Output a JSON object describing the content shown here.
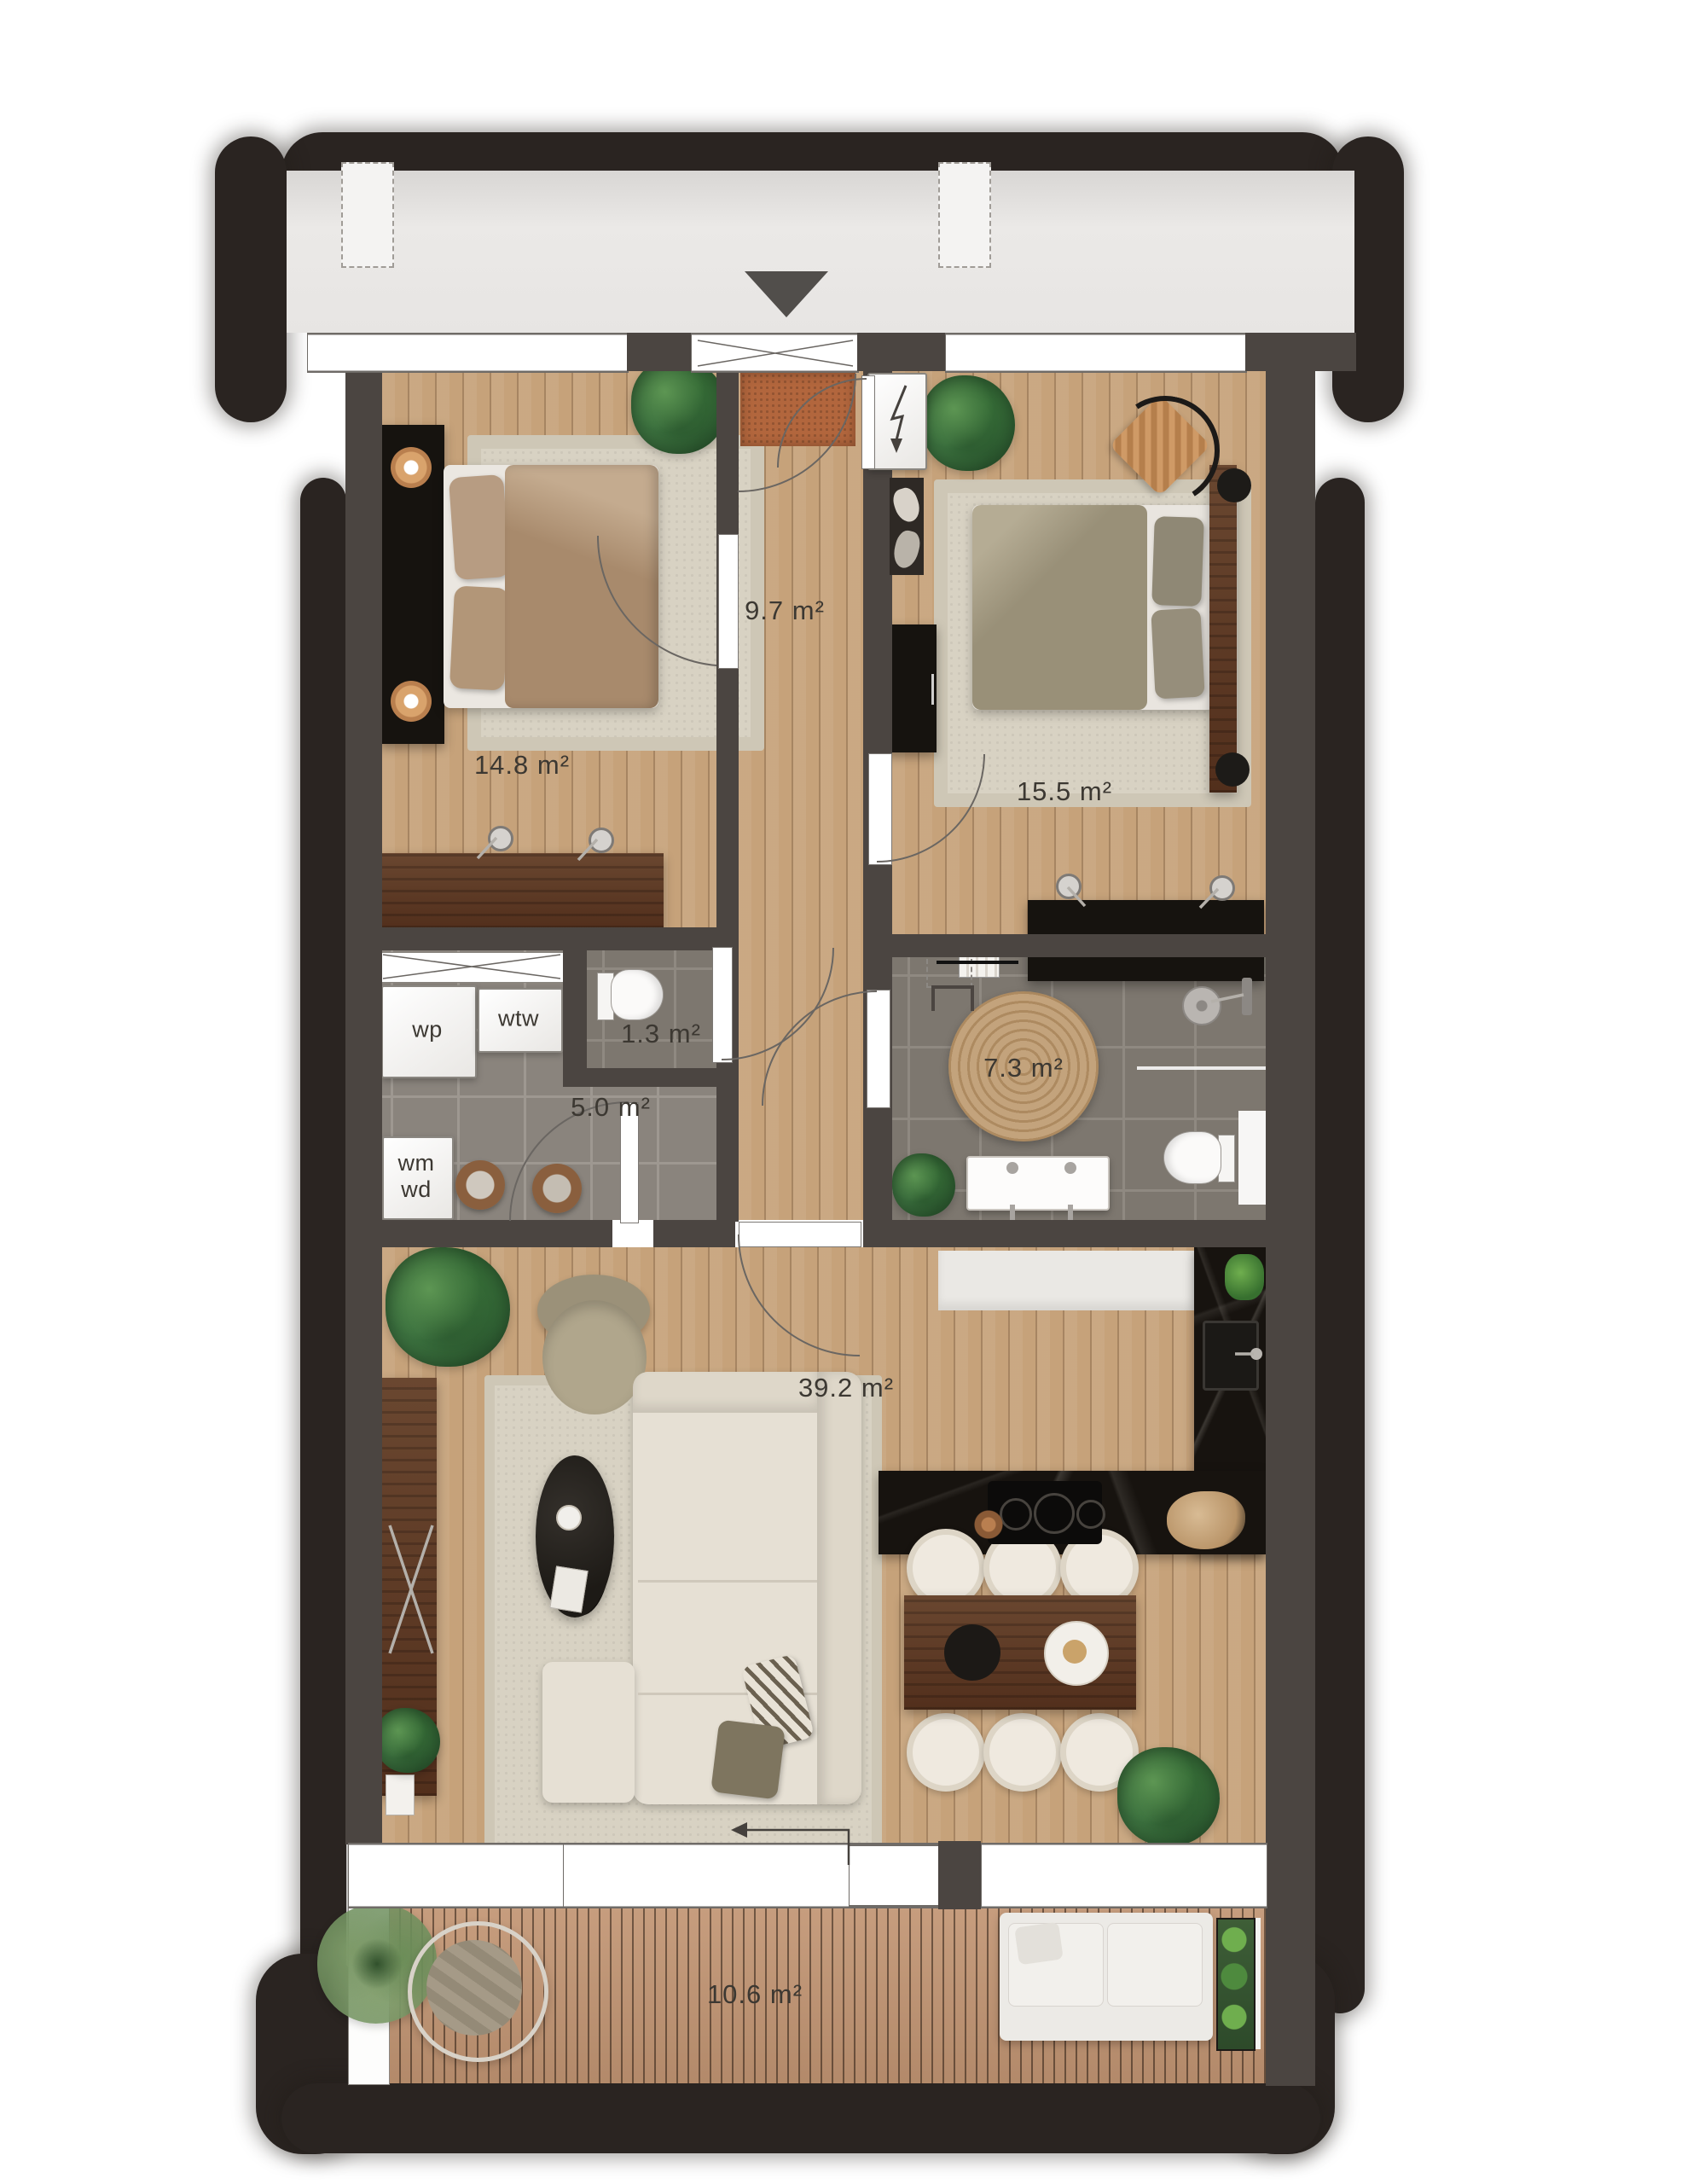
{
  "plan_title": "apartment floor plan",
  "rooms": {
    "hallway": {
      "area": "9.7 m²"
    },
    "bedroom_1": {
      "area": "14.8 m²"
    },
    "bedroom_2": {
      "area": "15.5 m²"
    },
    "toilet": {
      "area": "1.3 m²"
    },
    "utility": {
      "area": "5.0 m²"
    },
    "bathroom": {
      "area": "7.3 m²"
    },
    "living_kitchen": {
      "area": "39.2 m²"
    },
    "balcony": {
      "area": "10.6 m²"
    }
  },
  "equipment": {
    "heat_pump_label": "wp",
    "heat_recovery_label": "wtw",
    "washer_dryer_label": "wm\nwd"
  },
  "icons": {
    "entrance_marker": "triangle-down",
    "electric_meter": "lightning-arrow",
    "sliding_door": "left-arrow",
    "columns": "dashed-rectangles"
  },
  "colors": {
    "outer_wall": "#2a2421",
    "inner_wall": "#4b4541",
    "wood_floor": "#c6a27a",
    "deck_floor": "#c29573",
    "tile_floor": "#8a847d",
    "bathroom_tile": "#7d776f",
    "gallery": "#e9e7e5",
    "label_text": "#3c3832",
    "doormat": "#b2663d",
    "kitchen_counter": "#17130f"
  }
}
